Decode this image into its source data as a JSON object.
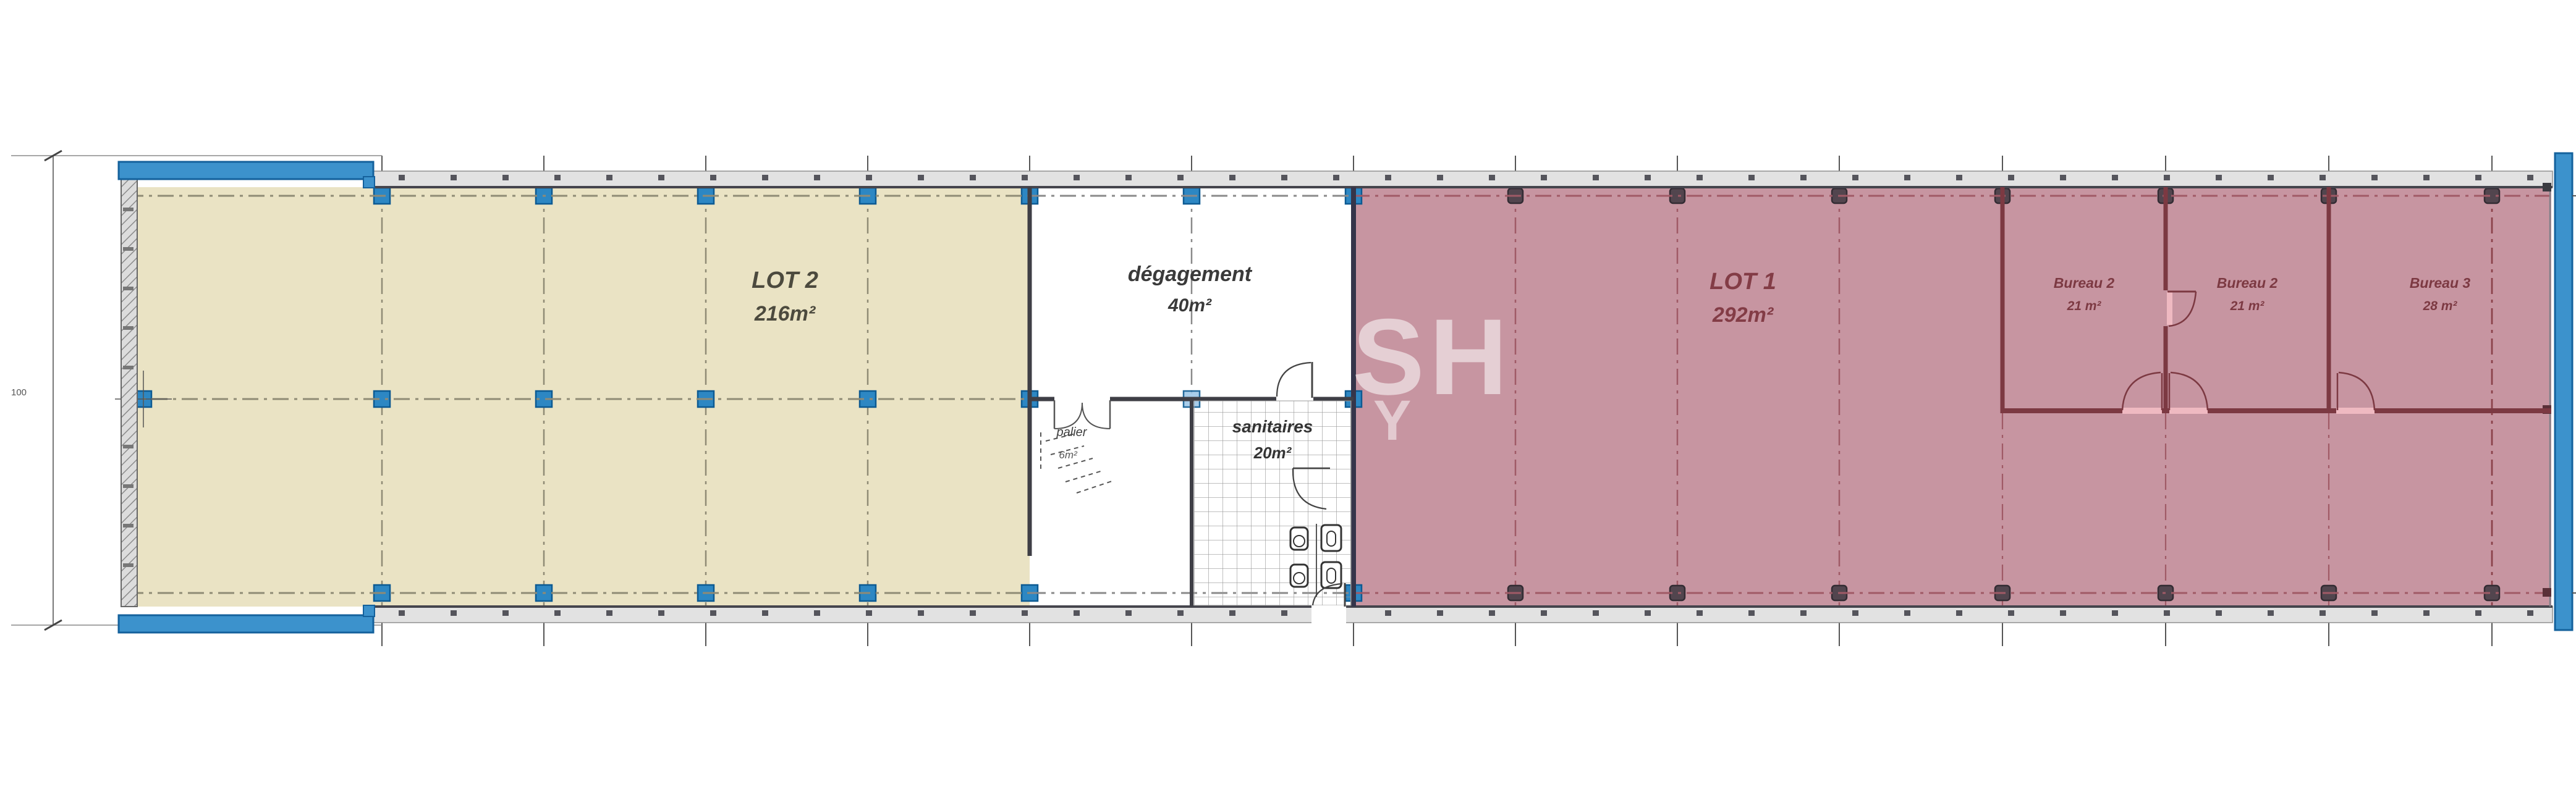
{
  "plan": {
    "dimension": {
      "label": "100"
    },
    "watermark": {
      "line1": "SH",
      "line2": "Y"
    },
    "rooms": {
      "lot2": {
        "name": "LOT 2",
        "area": "216m²"
      },
      "degagement": {
        "name": "dégagement",
        "area": "40m²"
      },
      "palier": {
        "name": "palier",
        "area": "6m²"
      },
      "sanitaires": {
        "name": "sanitaires",
        "area": "20m²"
      },
      "lot1": {
        "name": "LOT 1",
        "area": "292m²"
      },
      "bureau2a": {
        "name": "Bureau 2",
        "area": "21 m²"
      },
      "bureau2b": {
        "name": "Bureau 2",
        "area": "21 m²"
      },
      "bureau3": {
        "name": "Bureau 3",
        "area": "28 m²"
      }
    },
    "colors": {
      "lot2_fill": "#eae3c4",
      "lot1_fill": "#c795a1",
      "blue_wall": "#3c92cc",
      "dark_wall": "#3f3f46",
      "red_wall": "#7c3942",
      "red_text": "#833c46"
    }
  }
}
